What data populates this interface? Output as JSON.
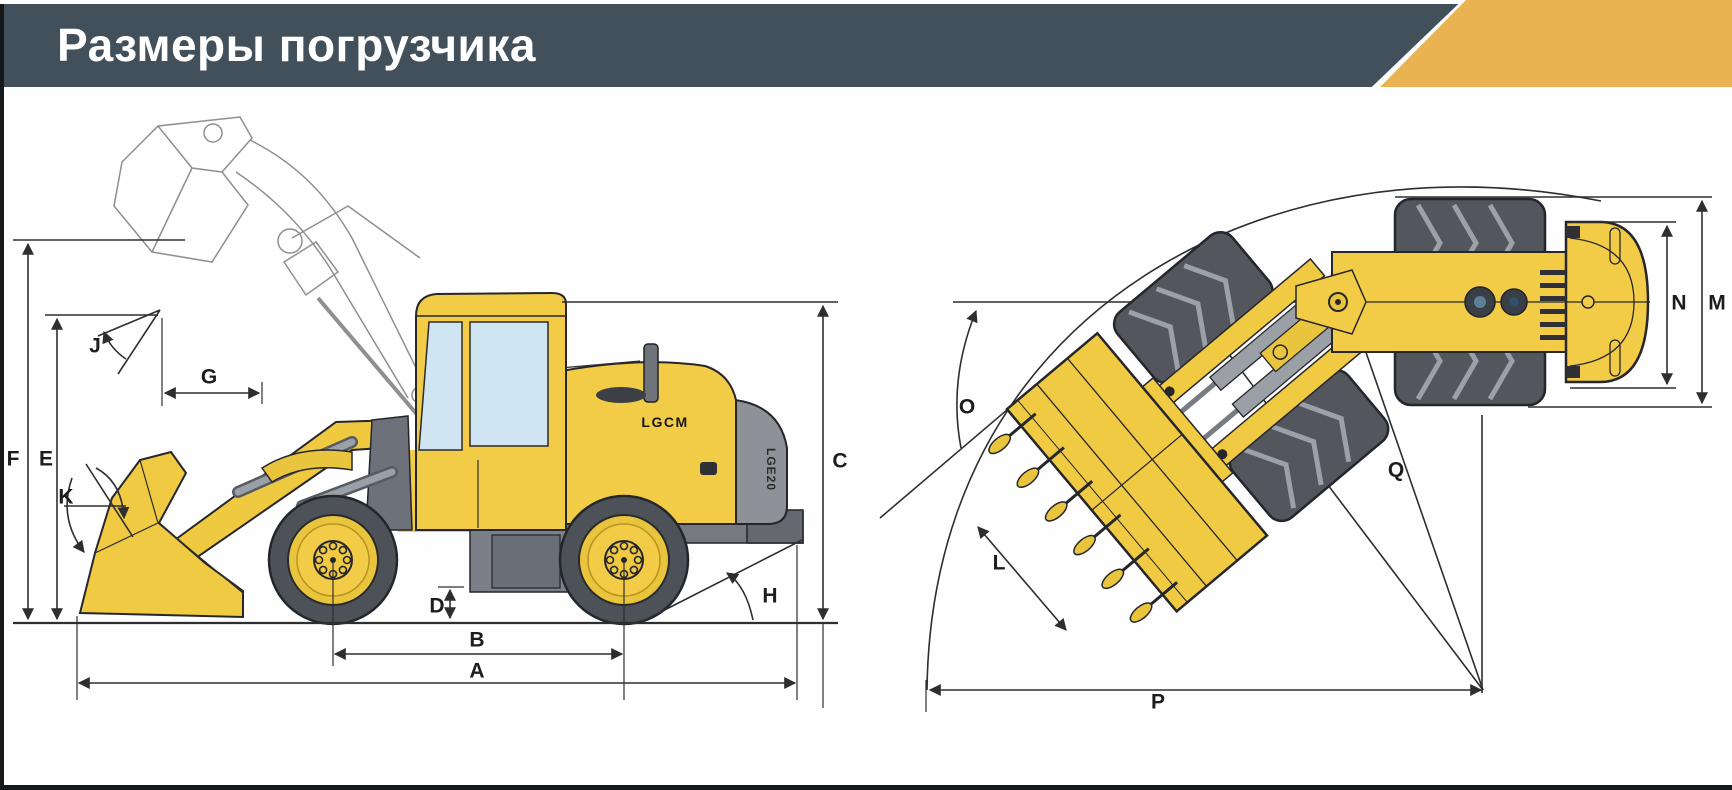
{
  "header": {
    "title": "Размеры погрузчика"
  },
  "side_view": {
    "brand": "LGCM",
    "model": "LGE20",
    "labels": {
      "A": "A",
      "B": "B",
      "C": "C",
      "D": "D",
      "E": "E",
      "F": "F",
      "G": "G",
      "H": "H",
      "J": "J",
      "K": "K"
    }
  },
  "top_view": {
    "labels": {
      "L": "L",
      "M": "M",
      "N": "N",
      "O": "O",
      "P": "P",
      "Q": "Q"
    }
  },
  "colors": {
    "header_bg": "#41505b",
    "accent": "#e9b352",
    "machine_yellow": "#f2cc47",
    "rim_yellow": "#e9c53e",
    "machine_gray": "#8e9298",
    "tire_gray": "#53565c",
    "window_blue": "#cfe6f2",
    "dimension_line": "#2e2e2e",
    "border_black": "#17181a"
  }
}
